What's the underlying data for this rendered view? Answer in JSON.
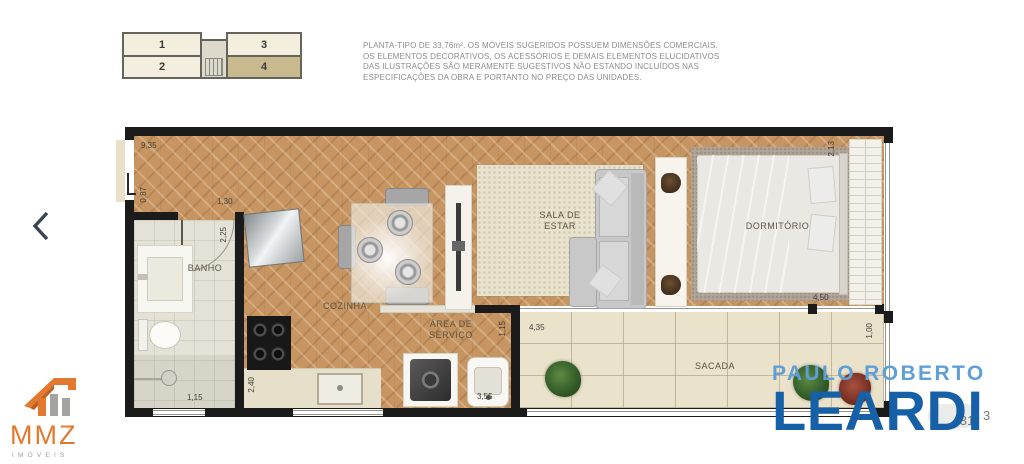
{
  "carousel": {
    "prev_label": "Foto anterior"
  },
  "key_plan": {
    "units": [
      "1",
      "2",
      "3",
      "4"
    ],
    "highlighted_unit": "4"
  },
  "disclaimer": {
    "lines": [
      "PLANTA-TIPO DE 33,76m². OS MÓVEIS SUGERIDOS POSSUEM DIMENSÕES COMERCIAIS.",
      "OS ELEMENTOS DECORATIVOS, OS ACESSÓRIOS E DEMAIS ELEMENTOS ELUCIDATIVOS",
      "DAS ILUSTRAÇÕES SÃO MERAMENTE SUGESTIVOS NÃO ESTANDO INCLUÍDOS NAS",
      "ESPECIFICAÇÕES DA OBRA E PORTANTO NO PREÇO DAS UNIDADES."
    ]
  },
  "floor_plan": {
    "labels": {
      "banho": "BANHO",
      "cozinha": "COZINHA",
      "sala_line1": "SALA DE",
      "sala_line2": "ESTAR",
      "dormitorio": "DORMITÓRIO",
      "servico_line1": "ÁREA DE",
      "servico_line2": "SERVIÇO",
      "sacada": "SACADA"
    },
    "dims": {
      "width_total": "9,35",
      "entry": "0,87",
      "hall": "1,30",
      "banho_depth": "2,25",
      "banho_width": "1,15",
      "cozinha_depth": "2,40",
      "servico_width": "3,55",
      "servico_depth": "1,15",
      "sacada_width": "4,35",
      "sacada_depth": "1,00",
      "dormitorio_width": "4,50",
      "dormitorio_window": "2,13"
    }
  },
  "logos": {
    "mmz": {
      "name": "MMZ",
      "subtitle": "IMÓVEIS",
      "accent": "#e2792e"
    },
    "leardi": {
      "line1": "PAULO ROBERTO",
      "line2": "LEARDI",
      "light_blue": "#5f9fd6",
      "dark_blue": "#1560a7"
    }
  },
  "photo_counter": {
    "fragment_left": "31",
    "fragment_right": "3"
  },
  "colors": {
    "wall": "#1b1b1b",
    "wood": "#c69562",
    "balcony_tile": "#eae2cb"
  }
}
